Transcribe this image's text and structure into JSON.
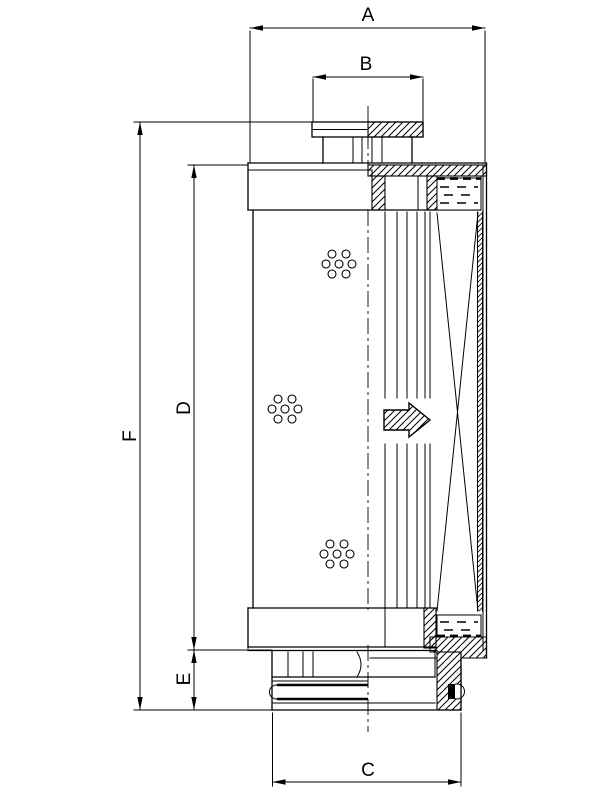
{
  "drawing": {
    "background": "#ffffff",
    "line_color": "#000000",
    "labels": {
      "a": "A",
      "b": "B",
      "c": "C",
      "d": "D",
      "e": "E",
      "f": "F"
    }
  }
}
